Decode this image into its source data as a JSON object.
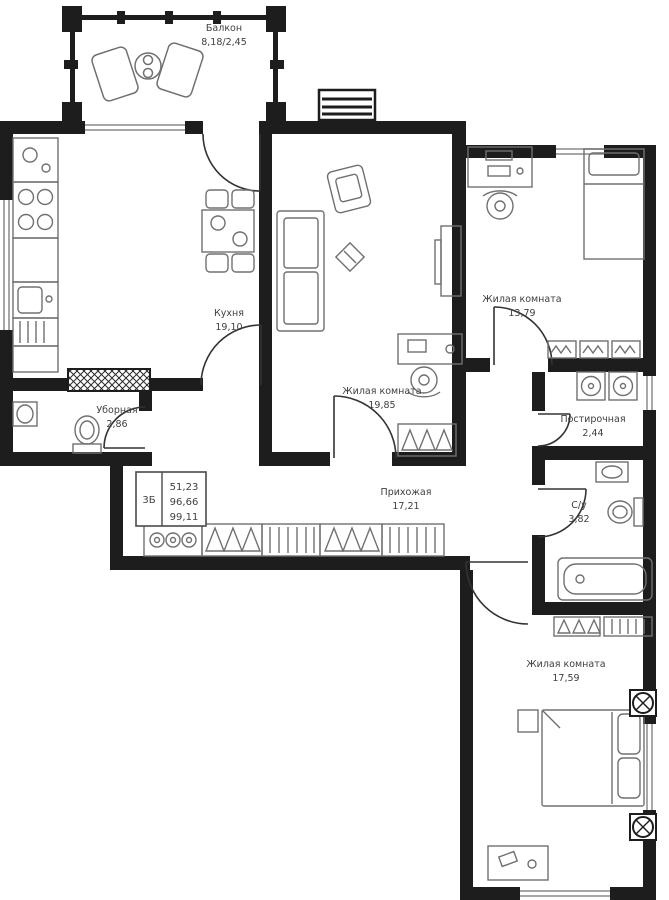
{
  "plan": {
    "info_table": {
      "type_label": "3Б",
      "living_area": "51,23",
      "area_no_balcony": "96,66",
      "total_area": "99,11"
    },
    "rooms": {
      "balcony": {
        "name": "Балкон",
        "area": "8,18/2,45"
      },
      "kitchen": {
        "name": "Кухня",
        "area": "19,10"
      },
      "toilet": {
        "name": "Уборная",
        "area": "2,86"
      },
      "living1": {
        "name": "Жилая комната",
        "area": "19,85"
      },
      "living2": {
        "name": "Жилая комната",
        "area": "13,79"
      },
      "laundry": {
        "name": "Постирочная",
        "area": "2,44"
      },
      "hallway": {
        "name": "Прихожая",
        "area": "17,21"
      },
      "bathroom": {
        "name": "С/у",
        "area": "3,82"
      },
      "living3": {
        "name": "Жилая комната",
        "area": "17,59"
      }
    },
    "colors": {
      "wall": "#1d1d1d",
      "furniture": "#707070",
      "label": "#3f3f3f",
      "background": "#ffffff"
    }
  }
}
